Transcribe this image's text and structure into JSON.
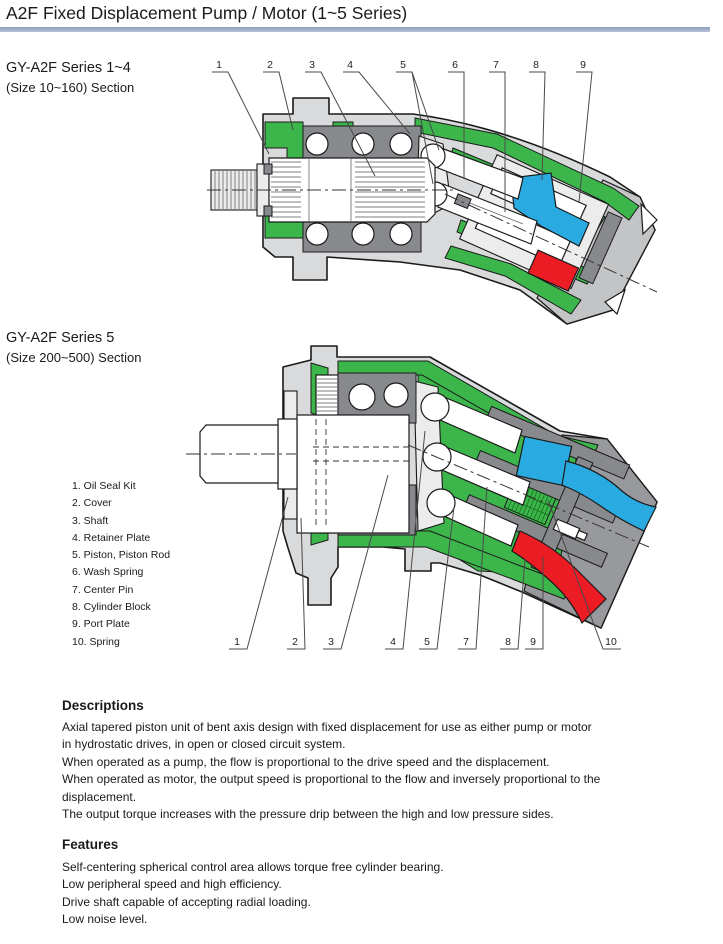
{
  "page": {
    "title": "A2F Fixed Displacement Pump / Motor (1~5 Series)"
  },
  "sections": {
    "series14": {
      "line1": "GY-A2F Series 1~4",
      "line2": "(Size 10~160) Section"
    },
    "series5": {
      "line1": "GY-A2F Series 5",
      "line2": "(Size 200~500) Section"
    }
  },
  "parts_list": [
    "1. Oil Seal Kit",
    "2. Cover",
    "3. Shaft",
    "4. Retainer Plate",
    "5. Piston, Piston Rod",
    "6. Wash Spring",
    "7. Center Pin",
    "8. Cylinder Block",
    "9. Port Plate",
    "10. Spring"
  ],
  "diagram1": {
    "callouts": [
      "1",
      "2",
      "3",
      "4",
      "5",
      "6",
      "7",
      "8",
      "9"
    ]
  },
  "diagram2": {
    "callouts": [
      "1",
      "2",
      "3",
      "4",
      "5",
      "7",
      "8",
      "9",
      "10"
    ]
  },
  "descriptions": {
    "heading": "Descriptions",
    "lines": [
      "Axial tapered piston unit of bent axis design with fixed displacement for use as either pump or motor",
      "in hydrostatic drives, in open or closed circuit system.",
      "When operated as a pump, the flow is proportional to the drive speed and the displacement.",
      "When operated as motor, the output speed is proportional to the flow and inversely proportional to the",
      "displacement.",
      "The output torque increases with the pressure drip between the high and low pressure sides."
    ]
  },
  "features": {
    "heading": "Features",
    "lines": [
      "Self-centering spherical control area allows torque free cylinder bearing.",
      "Low peripheral speed and high efficiency.",
      "Drive shaft capable of accepting radial loading.",
      "Low noise level."
    ]
  },
  "colors": {
    "title_rule": "#8da0bd",
    "housing_gray": "#d9dadb",
    "bearing_gray": "#87898c",
    "seal_green": "#3cb54a",
    "port_blue": "#29abe2",
    "port_red": "#ec1c24"
  }
}
